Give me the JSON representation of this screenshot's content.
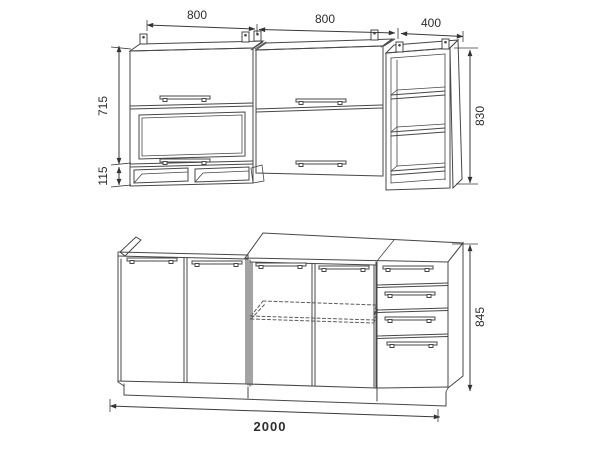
{
  "drawing": {
    "title": "kitchen-cabinet-set-technical-drawing",
    "colors": {
      "line": "#474747",
      "background": "#ffffff",
      "text": "#2e2e2e"
    },
    "dimensions": {
      "upper_widths": [
        "800",
        "800",
        "400"
      ],
      "upper_door_height": "715",
      "upper_open_shelf_height": "115",
      "upper_total_height": "830",
      "base_total_height": "845",
      "base_total_width": "2000"
    }
  }
}
